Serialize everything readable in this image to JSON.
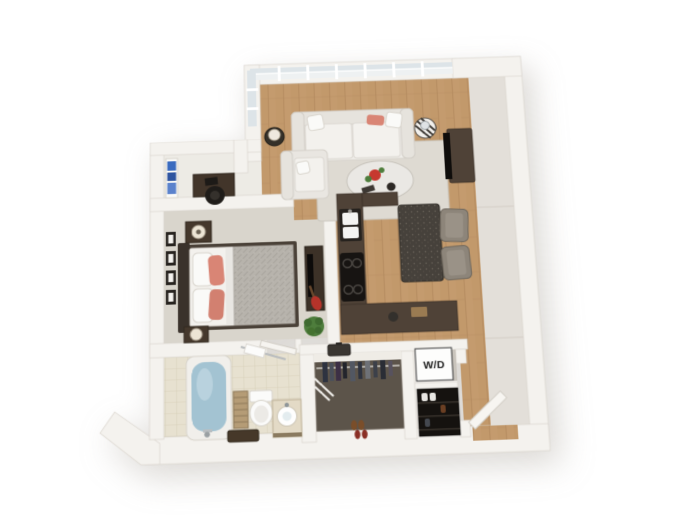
{
  "meta": {
    "type": "3d-floor-plan",
    "description": "3D top-down perspective rendering of a one-bedroom apartment floor plan on a white background",
    "view": "tilted top-down perspective"
  },
  "labels": {
    "washer_dryer": "W/D"
  },
  "colors": {
    "bg": "#ffffff",
    "wall": "#f4f2ee",
    "wall-edge": "#dbd6cf",
    "wall-face": "#e3dfd9",
    "wood": "#c49b6e",
    "wood-dark": "#ab8155",
    "tile": "#ebe5d4",
    "tile-line": "#d5cdb6",
    "bath-tile": "#e7e1d0",
    "carpet": "#d9d5cc",
    "hall": "#edebe5",
    "closet-floor": "#5c544a",
    "counter": "#4f4237",
    "rug": "#dedad2",
    "sofa": "#efede9",
    "accent-coral": "#d98575",
    "water": "#a3c3d2",
    "plant": "#4e7d3c",
    "glass": "#eef1f2",
    "glass-2": "#dde4e8",
    "text": "#1c1c1c"
  },
  "rooms": [
    {
      "id": "living-room",
      "floor": "hardwood",
      "furniture": [
        "sofa-with-coral-pillow",
        "armchair",
        "organic-coffee-table-with-flowers",
        "area-rug",
        "tv-stand-with-tv",
        "side-table-with-lamp",
        "striped-drum-table",
        "floor-to-ceiling-window-wall"
      ]
    },
    {
      "id": "dining-area",
      "floor": "hardwood",
      "furniture": [
        "stone-dining-table",
        "two-gray-chairs"
      ]
    },
    {
      "id": "kitchen",
      "floor": "tile",
      "furniture": [
        "u-shaped-dark-counter",
        "double-sink",
        "four-burner-cooktop"
      ]
    },
    {
      "id": "den-nook",
      "floor": "light-carpet",
      "furniture": [
        "desk",
        "black-desk-chair",
        "shelf-with-blue-books"
      ]
    },
    {
      "id": "bedroom",
      "floor": "carpet",
      "furniture": [
        "double-bed-coral-pillows-gray-duvet",
        "two-nightstands-with-lamps",
        "four-wall-art-frames",
        "media-console",
        "red-guitar",
        "potted-plant"
      ]
    },
    {
      "id": "bathroom",
      "floor": "tile",
      "furniture": [
        "bathtub-with-water",
        "toilet",
        "vanity-with-vessel-sink",
        "striped-hamper",
        "storage-bench",
        "towel-bar",
        "open-door"
      ]
    },
    {
      "id": "walk-in-closet",
      "floor": "dark-carpet",
      "furniture": [
        "hanging-clothes-rod",
        "suitcase-on-shelf",
        "white-shelf-rods",
        "shoe-pairs"
      ]
    },
    {
      "id": "laundry-closet",
      "floor": "tile",
      "furniture": [
        "stacked-washer-dryer-unit",
        "shoe-rack"
      ]
    },
    {
      "id": "entry",
      "floor": "hardwood",
      "furniture": [
        "open-front-door"
      ]
    }
  ]
}
